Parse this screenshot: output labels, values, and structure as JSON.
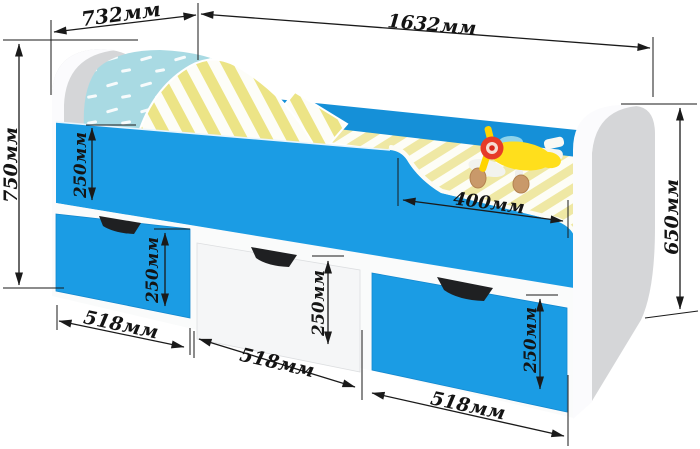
{
  "dimensions": {
    "top_width": "732мм",
    "top_length": "1632мм",
    "left_height": "750мм",
    "rail_height": "250мм",
    "drawer_left_height": "250мм",
    "drawer_middle_height": "250мм",
    "drawer_right_height": "250мм",
    "drawer_left_width": "518мм",
    "drawer_middle_width": "518мм",
    "drawer_right_width": "518мм",
    "opening_width": "400мм",
    "footboard_height": "650мм"
  },
  "colors": {
    "bed_blue": "#1b9ce4",
    "bed_blue_far": "#1590d8",
    "panel_gray": "#d5d6d8",
    "panel_rim_white": "#fbfbfd",
    "drawer_white": "#f5f6f7",
    "stripe_yellow": "#efe8a4",
    "pillow_blue": "#a9dae3",
    "dimension_line": "#1a1a1a",
    "background": "#ffffff"
  }
}
